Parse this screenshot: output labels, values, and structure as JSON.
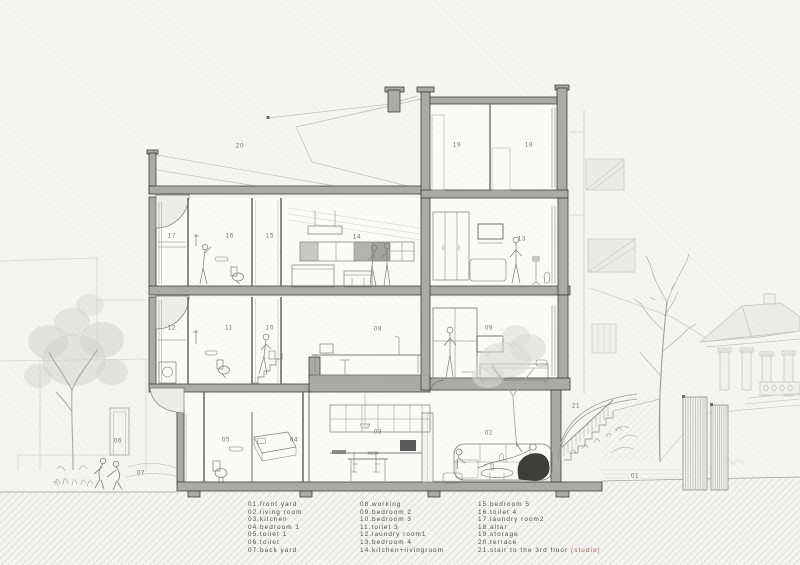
{
  "drawing": {
    "room_labels": {
      "r01": "01",
      "r02": "02",
      "r03": "03",
      "r04": "04",
      "r05": "05",
      "r06": "06",
      "r07": "07",
      "r08": "08",
      "r09": "09",
      "r10": "10",
      "r11": "11",
      "r12": "12",
      "r13": "13",
      "r14": "14",
      "r15": "15",
      "r16": "16",
      "r17": "17",
      "r18": "18",
      "r19": "19",
      "r20": "20",
      "r21": "21"
    }
  },
  "legend": {
    "columns": [
      {
        "items": [
          "01.front yard",
          "02.living room",
          "03.kitchen",
          "04.bedroom 1",
          "05.toilet 1",
          "06.toilet",
          "07.back yard"
        ]
      },
      {
        "items": [
          "08.working",
          "09.bedroom 2",
          "10.bedroom 3",
          "11.toilet 3",
          "12.laundry room1",
          "13.bedroom 4",
          "14.kitchen+livingroom"
        ]
      },
      {
        "items": [
          "15.bedroom 5",
          "16.toilet 4",
          "17.laundry room2",
          "18.altar",
          "19.storage",
          "20.terrace",
          {
            "text": "21.stair to the 3rd floor ",
            "accent": "(studio)"
          }
        ]
      }
    ]
  },
  "colors": {
    "accent_studio": "#b0594d",
    "cut_wall_fill": "#ababa9",
    "line": "#6e6e6c",
    "paper": "#f5f5f3"
  }
}
